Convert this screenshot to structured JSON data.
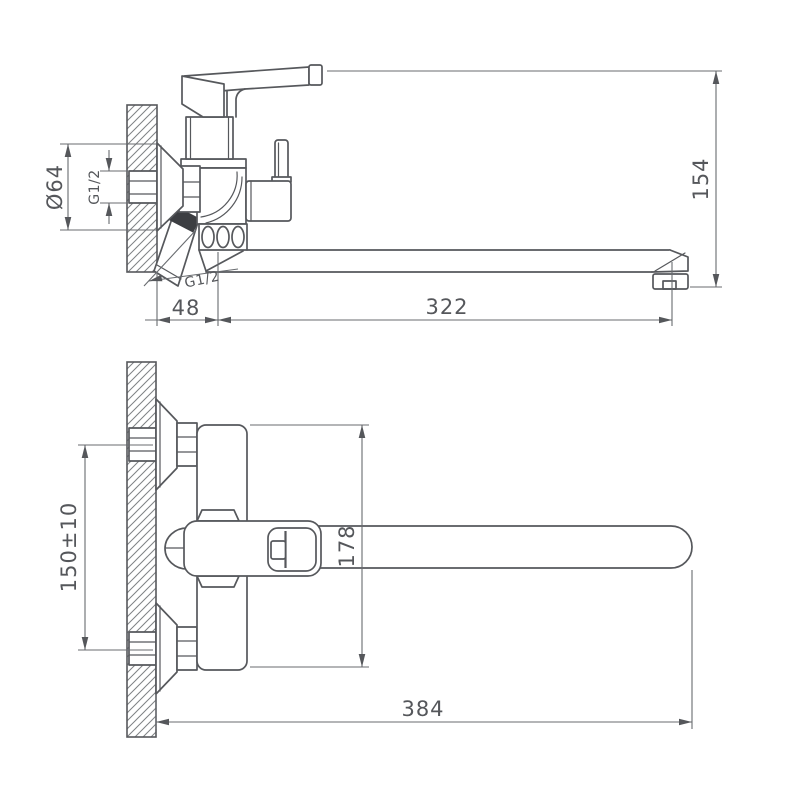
{
  "drawing": {
    "type": "faucet-technical-drawing",
    "views": {
      "side_view": {
        "flange_diameter_label": "Ø64",
        "inlet_thread_label": "G1/2",
        "outlet_thread_label": "G1/2",
        "height_label": "154",
        "wall_offset_label": "48",
        "spout_reach_label": "322"
      },
      "front_view": {
        "mount_spacing_label": "150±10",
        "vertical_span_label": "178",
        "overall_length_label": "384"
      }
    },
    "colors": {
      "background": "#ffffff",
      "outline": "#56585c",
      "dimension_line": "#686b6f",
      "text": "#55575b",
      "section_fill": "#3c3e42"
    }
  }
}
